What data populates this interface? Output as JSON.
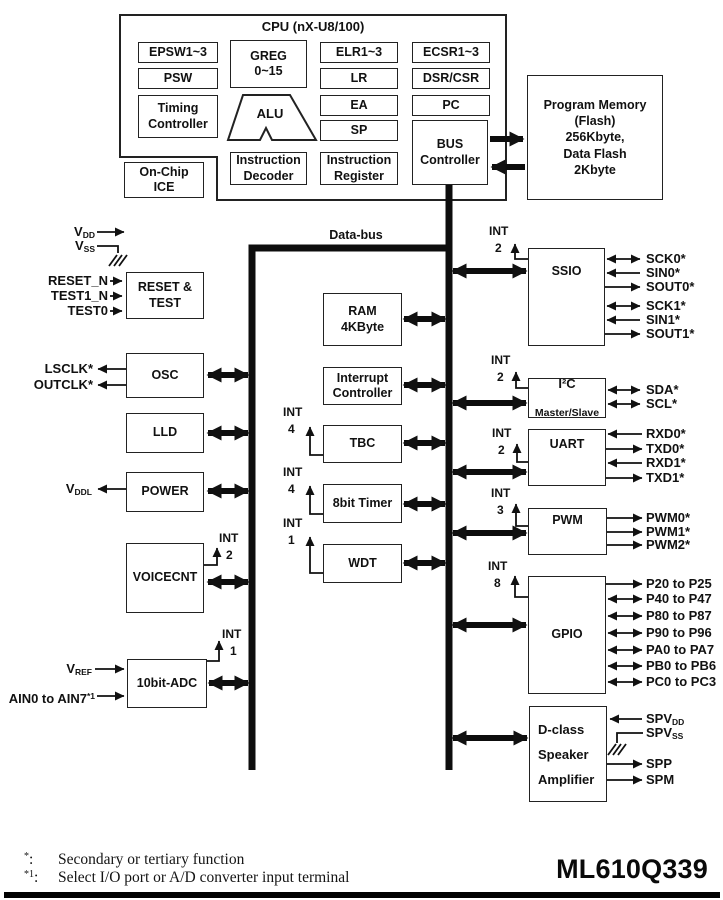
{
  "header": {
    "cpu_title": "CPU (nX-U8/100)"
  },
  "bus": {
    "label": "Data-bus"
  },
  "cpu": {
    "epsw": "EPSW1~3",
    "psw": "PSW",
    "timing": "Timing\nController",
    "greg": "GREG\n0~15",
    "alu": "ALU",
    "elr": "ELR1~3",
    "lr": "LR",
    "ea": "EA",
    "sp": "SP",
    "idec": "Instruction\nDecoder",
    "ireg": "Instruction\nRegister",
    "ecsr": "ECSR1~3",
    "dsr": "DSR/CSR",
    "pc": "PC",
    "busctrl": "BUS\nController",
    "ice": "On-Chip\nICE"
  },
  "memory": {
    "label": "Program Memory\n(Flash)\n256Kbyte,\nData Flash\n2Kbyte"
  },
  "left": {
    "vdd": {
      "base": "V",
      "sub": "DD"
    },
    "vss": {
      "base": "V",
      "sub": "SS"
    },
    "reset": {
      "label": "RESET &\nTEST",
      "pins": [
        "RESET_N",
        "TEST1_N",
        "TEST0"
      ]
    },
    "osc": {
      "label": "OSC",
      "pins": [
        "LSCLK*",
        "OUTCLK*"
      ]
    },
    "lld": {
      "label": "LLD"
    },
    "power": {
      "label": "POWER",
      "vddl": {
        "base": "V",
        "sub": "DDL"
      }
    },
    "voicecnt": {
      "label": "VOICECNT",
      "int": "INT",
      "int_count": "2"
    },
    "adc": {
      "label": "10bit-ADC",
      "int": "INT",
      "int_count": "1",
      "vref": {
        "base": "V",
        "sub": "REF"
      },
      "ain": {
        "base": "AIN0 to AIN7",
        "sup": "*1"
      }
    }
  },
  "middle": {
    "ram": "RAM\n4KByte",
    "intctrl": "Interrupt\nController",
    "tbc": {
      "label": "TBC",
      "int": "INT",
      "int_count": "4"
    },
    "timer8": {
      "label": "8bit Timer",
      "int": "INT",
      "int_count": "4"
    },
    "wdt": {
      "label": "WDT",
      "int": "INT",
      "int_count": "1"
    }
  },
  "right": {
    "ssio": {
      "label": "SSIO",
      "int": "INT",
      "int_count": "2",
      "signals": [
        "SCK0*",
        "SIN0*",
        "SOUT0*",
        "SCK1*",
        "SIN1*",
        "SOUT1*"
      ]
    },
    "i2c": {
      "label": "I²C",
      "sublabel": "Master/Slave",
      "int": "INT",
      "int_count": "2",
      "signals": [
        "SDA*",
        "SCL*"
      ]
    },
    "uart": {
      "label": "UART",
      "int": "INT",
      "int_count": "2",
      "signals": [
        "RXD0*",
        "TXD0*",
        "RXD1*",
        "TXD1*"
      ]
    },
    "pwm": {
      "label": "PWM",
      "int": "INT",
      "int_count": "3",
      "signals": [
        "PWM0*",
        "PWM1*",
        "PWM2*"
      ]
    },
    "gpio": {
      "label": "GPIO",
      "int": "INT",
      "int_count": "8",
      "signals": [
        "P20 to P25",
        "P40 to P47",
        "P80 to P87",
        "P90 to P96",
        "PA0 to PA7",
        "PB0 to PB6",
        "PC0 to PC3"
      ]
    },
    "dclass": {
      "label": "D-class\nSpeaker\nAmplifier",
      "spvdd": {
        "base": "SPV",
        "sub": "DD"
      },
      "spvss": {
        "base": "SPV",
        "sub": "SS"
      },
      "signals": [
        "SPP",
        "SPM"
      ]
    }
  },
  "footer": {
    "product": "ML610Q339",
    "notes": [
      {
        "marker": "*",
        "sep": ":",
        "text": "Secondary or tertiary function"
      },
      {
        "marker": "*1",
        "sep": ":",
        "text": "Select I/O port or A/D converter input terminal"
      }
    ]
  }
}
